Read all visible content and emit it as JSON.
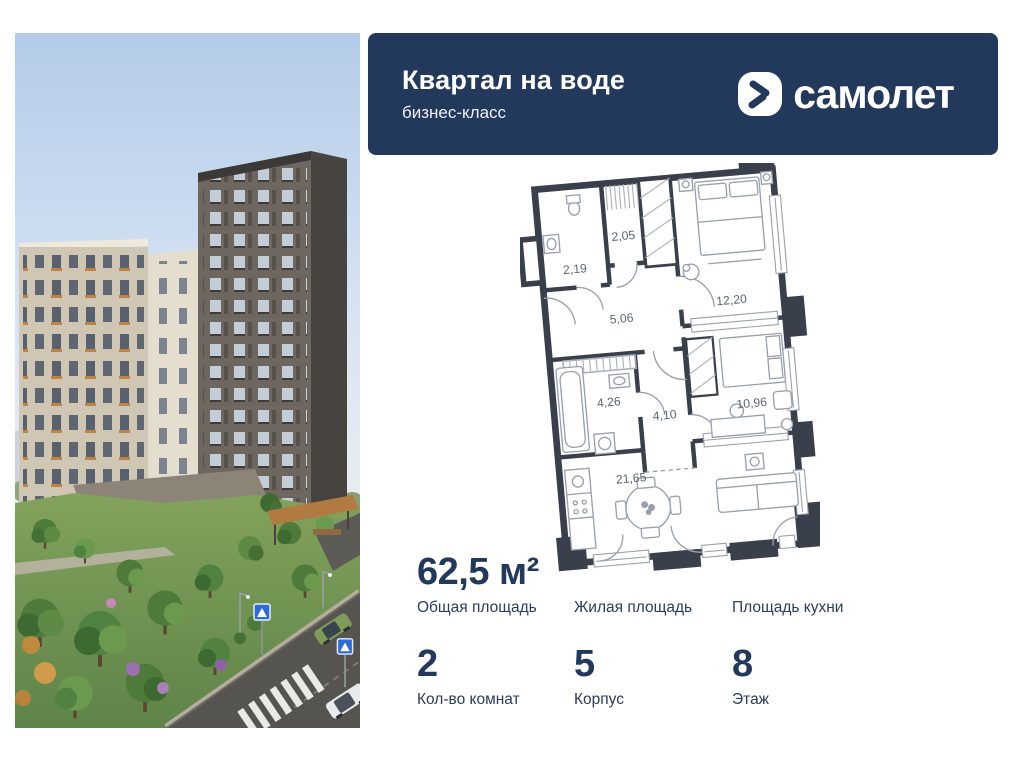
{
  "theme": {
    "accent_navy": "#22395c",
    "page_bg": "#ffffff"
  },
  "header": {
    "title": "Квартал на воде",
    "subtitle": "бизнес-класс",
    "logo_text": "самолет"
  },
  "floor_plan": {
    "rooms": [
      {
        "name": "bathroom-guest",
        "area_label": "2,19"
      },
      {
        "name": "wardrobe",
        "area_label": "2,05"
      },
      {
        "name": "hallway",
        "area_label": "5,06"
      },
      {
        "name": "bedroom-1",
        "area_label": "12,20"
      },
      {
        "name": "bathroom-main",
        "area_label": "4,26"
      },
      {
        "name": "hall",
        "area_label": "4,10"
      },
      {
        "name": "bedroom-2",
        "area_label": "10,96"
      },
      {
        "name": "kitchen-living",
        "area_label": "21,65"
      }
    ]
  },
  "stats": {
    "cells": [
      {
        "value": "62,5 м²",
        "label": "Общая площадь"
      },
      {
        "value": "",
        "label": "Жилая площадь"
      },
      {
        "value": "",
        "label": "Площадь кухни"
      },
      {
        "value": "2",
        "label": "Кол-во комнат"
      },
      {
        "value": "5",
        "label": "Корпус"
      },
      {
        "value": "8",
        "label": "Этаж"
      }
    ]
  }
}
